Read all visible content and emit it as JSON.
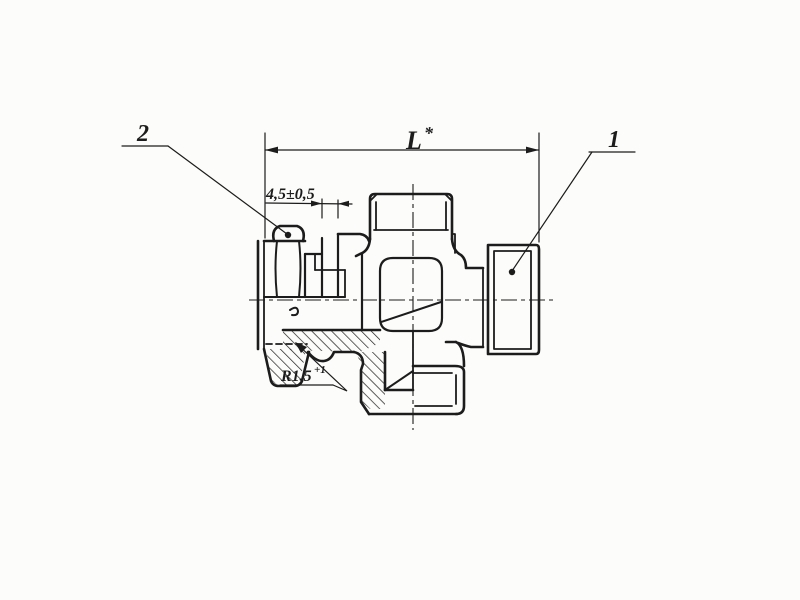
{
  "drawing": {
    "type": "technical-sectional-drawing",
    "subject": "pipe union cross fitting, half-section view",
    "colors": {
      "paper": "#fcfcfa",
      "ink": "#1c1c1c"
    }
  },
  "labels": {
    "length_dim": "L",
    "length_dim_sup": "*",
    "gap_dim": "4,5±0,5",
    "radius_dim": "R1,5",
    "radius_dim_sup": "+1",
    "callout_nut": "2",
    "callout_cap": "1"
  }
}
